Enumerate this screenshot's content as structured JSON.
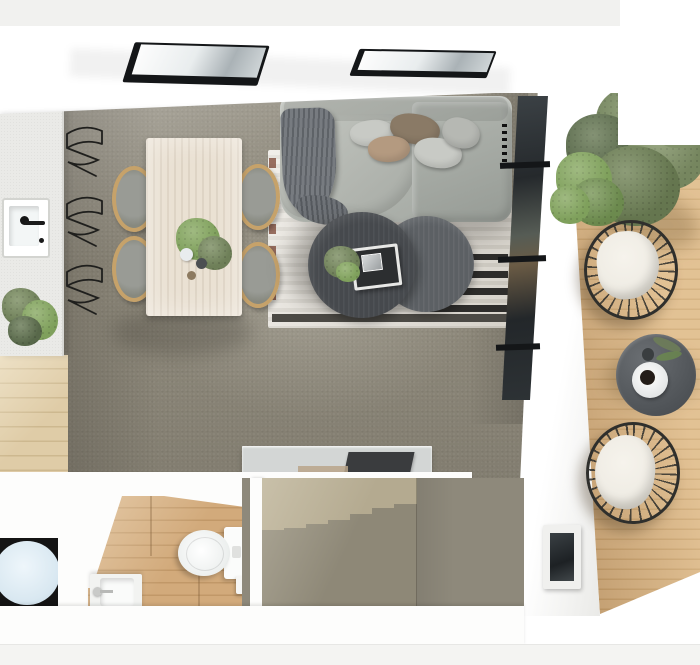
{
  "scene": {
    "name": "3d-floor-plan-top-view",
    "aria_label": "Photorealistic 3D rendered top-down floor plan of a small apartment: kitchen with island counter and sink, dining table with four wishbone chairs, living room with grey sectional sofa, striped rug and two round coffee tables, two roof skylights, glazed wall to a timber balcony deck with two wicker chairs, round table and plants, plus bathroom with toilet and basin, carpeted staircase, console table and laundry appliance."
  },
  "counts": {
    "skylights": 2,
    "dining_chairs": 4,
    "wire_wall_chairs": 3,
    "sofa_pillows": 5,
    "coffee_tables": 2,
    "stair_steps": 7,
    "balcony_chairs": 2,
    "balcony_plants": 2,
    "rug_black_dashes": 4
  },
  "rooms": {
    "kitchen": {
      "objects": [
        "island-counter",
        "sink",
        "black-faucet",
        "potted-plant",
        "wire-chair-stack",
        "oak-floor-strip"
      ]
    },
    "dining": {
      "objects": [
        "light-oak-table",
        "wishbone-chair x4",
        "centerpiece-plant",
        "vases"
      ]
    },
    "living": {
      "objects": [
        "grey-sectional-sofa",
        "throw-blanket",
        "cushions x5",
        "striped-rug",
        "round-coffee-table x2",
        "decor-tray",
        "small-plant"
      ]
    },
    "balcony": {
      "objects": [
        "timber-deck",
        "large-potted-plant",
        "small-shrub",
        "wicker-chair x2",
        "round-side-table",
        "coffee-cup-plate",
        "small-vase",
        "facade-window"
      ]
    },
    "bathroom": {
      "objects": [
        "toilet",
        "cistern",
        "wall-basin",
        "toilet-roll-holder",
        "oak-floor"
      ]
    },
    "hall": {
      "objects": [
        "console-table",
        "dark-tray",
        "staircase",
        "laundry-appliance"
      ]
    }
  },
  "palette": {
    "wall": "#fdfdfc",
    "top_band": "#eeeeec",
    "carpet": "#8e897b",
    "carpet_light": "#aaa28e",
    "counter": "#eaeae7",
    "wood_floor": "#dfcca7",
    "wood_floor_dark": "#cdb88f",
    "bath_wood": "#d2aa7b",
    "bath_wood_dark": "#c19868",
    "deck": "#d5ad7c",
    "deck_dark": "#c39862",
    "table_wood": "#eae1d3",
    "chair_wood": "#c6a26a",
    "chair_seat": "#999b95",
    "sofa": "#a2a7a1",
    "sofa_light": "#c0c3bd",
    "sofa_dark": "#8d928c",
    "throw": "#5f6368",
    "pillow_light": "#c8cac5",
    "pillow_brown": "#8a7a66",
    "pillow_taupe": "#b49a80",
    "rug_light": "#e8e4dc",
    "rug_mid": "#d6d2c9",
    "rug_band": "#4c4a45",
    "rug_red": "#7a4433",
    "ctable_dark": "#46494d",
    "ctable_mid": "#5c6064",
    "glass": "#262b2e",
    "frame": "#141618",
    "plant": "#6e7f58",
    "plant_dark": "#58684a",
    "plant_bright": "#7fa05c",
    "pot": "#90928e",
    "cushion": "#efece4",
    "chair_black": "#2f2f2c",
    "step_light": "#b4aa90",
    "step_dark": "#8e8877",
    "console": "#d3d6d5",
    "console_dark": "#3a3c3e",
    "washer": "#141414",
    "washer_drum": "#d9e8f1",
    "porcelain": "#fbfcfb",
    "bottom_bg": "#f4f4f2"
  }
}
